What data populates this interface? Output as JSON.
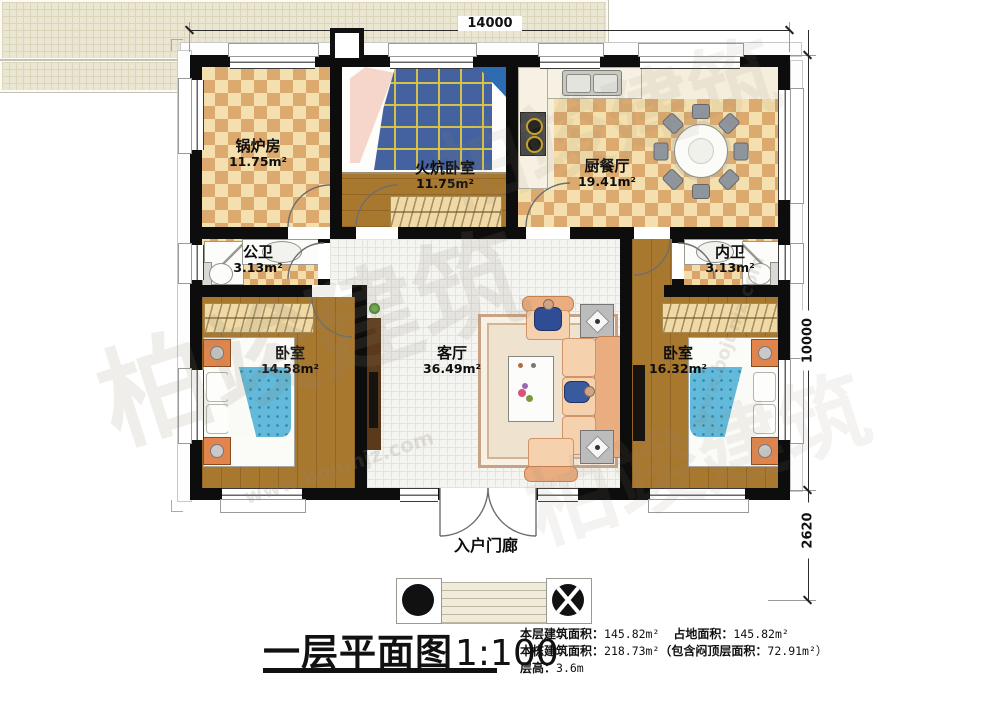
{
  "watermark": {
    "brand": "柏竣建筑",
    "site": "www.bojunjz.com"
  },
  "dimensions": {
    "top": "14000",
    "side": "10000",
    "porch": "2620"
  },
  "rooms": {
    "boiler": {
      "name": "锅炉房",
      "area": "11.75m²"
    },
    "kang": {
      "name": "火炕卧室",
      "area": "11.75m²"
    },
    "kitchen": {
      "name": "厨餐厅",
      "area": "19.41m²"
    },
    "bath_public": {
      "name": "公卫",
      "area": "3.13m²"
    },
    "bath_private": {
      "name": "内卫",
      "area": "3.13m²"
    },
    "bedroom_left": {
      "name": "卧室",
      "area": "14.58m²"
    },
    "living": {
      "name": "客厅",
      "area": "36.49m²"
    },
    "bedroom_right": {
      "name": "卧室",
      "area": "16.32m²"
    },
    "porch": {
      "name": "入户门廊"
    }
  },
  "titleblock": {
    "title": "一层平面图",
    "scale": "1:100",
    "stats": [
      {
        "label": "本层建筑面积：",
        "value": "145.82m²"
      },
      {
        "label": "占地面积：",
        "value": "145.82m²"
      },
      {
        "label": "本栋建筑面积：",
        "value": "218.73m²"
      },
      {
        "label": "（包含闷顶层面积：",
        "value": "72.91m²）"
      },
      {
        "label": "层高：",
        "value": "3.6m"
      }
    ]
  }
}
